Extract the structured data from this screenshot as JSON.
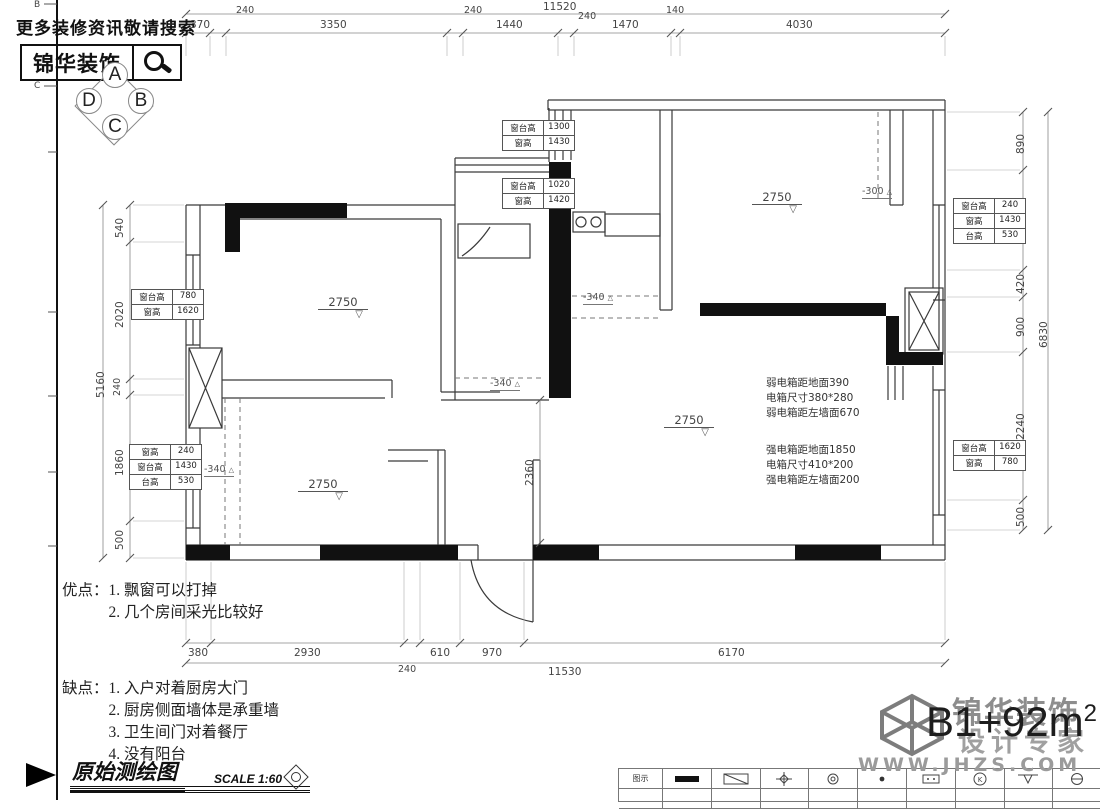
{
  "header": {
    "search_hint": "更多装修资讯敬请搜索",
    "brand": "锦华装饰"
  },
  "compass": {
    "a": "A",
    "b": "B",
    "c": "C",
    "d": "D"
  },
  "frame": {
    "letters": [
      "B",
      "C"
    ]
  },
  "dims": {
    "top_total": "11520",
    "top": [
      "370",
      "240",
      "3350",
      "240",
      "1440",
      "240",
      "1470",
      "140",
      "4030"
    ],
    "left_total": "5160",
    "left": [
      "540",
      "2020",
      "240",
      "1860",
      "500"
    ],
    "right_total": "6830",
    "right": [
      "890",
      "1650",
      "420",
      "900",
      "2240",
      "500"
    ],
    "bottom_total": "11530",
    "bottom": [
      "380",
      "2930",
      "240",
      "610",
      "970",
      "6170"
    ],
    "interior": "2360"
  },
  "levels": [
    "2750",
    "2750",
    "2750",
    "2750"
  ],
  "drops": [
    "-340",
    "-340",
    "-340",
    "-300"
  ],
  "window_tables": {
    "t1": [
      [
        "窗台高",
        "1300"
      ],
      [
        "窗高",
        "1430"
      ]
    ],
    "t2": [
      [
        "窗台高",
        "1020"
      ],
      [
        "窗高",
        "1420"
      ]
    ],
    "l1": [
      [
        "窗台高",
        "780"
      ],
      [
        "窗高",
        "1620"
      ]
    ],
    "l2": [
      [
        "窗高",
        "240"
      ],
      [
        "窗台高",
        "1430"
      ],
      [
        "台高",
        "530"
      ]
    ],
    "r1": [
      [
        "窗台高",
        "240"
      ],
      [
        "窗高",
        "1430"
      ],
      [
        "台高",
        "530"
      ]
    ],
    "r2": [
      [
        "窗台高",
        "1620"
      ],
      [
        "窗高",
        "780"
      ]
    ]
  },
  "electric": {
    "weak": [
      "弱电箱距地面390",
      "电箱尺寸380*280",
      "弱电箱距左墙面670"
    ],
    "strong": [
      "强电箱距地面1850",
      "电箱尺寸410*200",
      "强电箱距左墙面200"
    ]
  },
  "notes": {
    "pros_label": "优点：",
    "pros": [
      "1. 飘窗可以打掉",
      "2. 几个房间采光比较好"
    ],
    "cons_label": "缺点：",
    "cons": [
      "1. 入户对着厨房大门",
      "2. 厨房侧面墙体是承重墙",
      "3. 卫生间门对着餐厅",
      "4. 没有阳台"
    ]
  },
  "titleblock": {
    "title": "原始测绘图",
    "scale": "SCALE 1:60"
  },
  "footer": {
    "brand": "锦华装饰",
    "tagline": "设计专家",
    "area": "B1+92m",
    "area_sup": "2",
    "website": "WWW.JHZS.COM",
    "legend_first_cell": "图示"
  },
  "colors": {
    "wall_fill": "#111111",
    "line": "#3a3a3a",
    "dim_line": "#888888"
  }
}
